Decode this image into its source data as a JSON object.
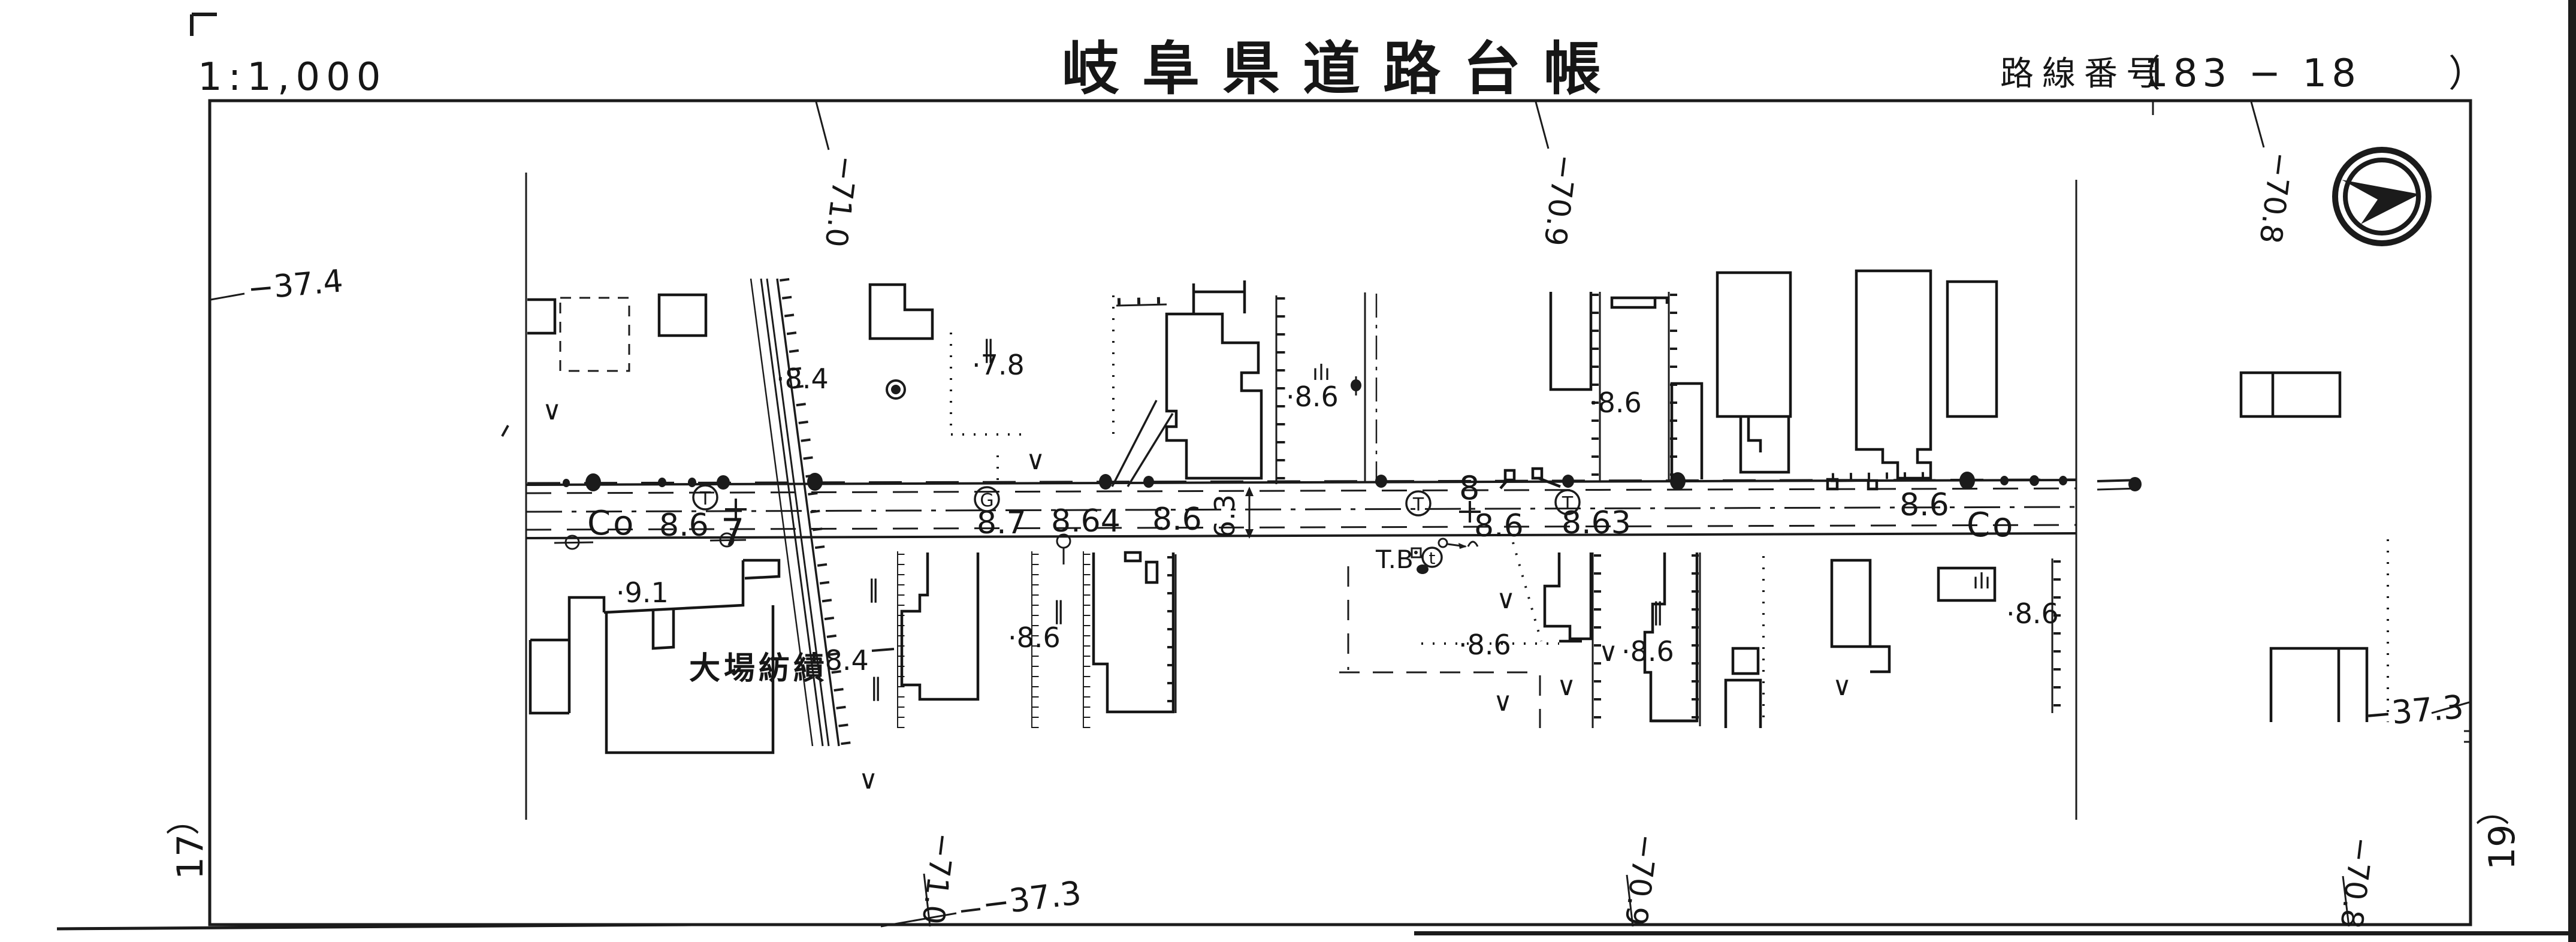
{
  "header": {
    "scale": "1:1,000",
    "title": "岐阜県道路台帳",
    "route_label": "路線番号",
    "route_open": "（",
    "route_number": "183 − 18",
    "route_close": "）"
  },
  "icons": {
    "north_arrow": "double-circle-dart-pointing-right"
  },
  "sheet_refs": {
    "left_paren": "（",
    "left_number": "17",
    "right_paren": "（",
    "right_number": "19"
  },
  "grid_labels": {
    "top": [
      "−71.0",
      "−70.9",
      "−70.8"
    ],
    "bottom": [
      "−71.0",
      "−70.9",
      "−70.8"
    ],
    "left": "−37.4",
    "bottom_diagonal": "−37.3",
    "right": "−37.3"
  },
  "road": {
    "co_left": "Co",
    "co_right": "Co",
    "widths": [
      "8.6",
      "8.7",
      "8.64",
      "8.6",
      "8.6",
      "8.63",
      "8.6"
    ],
    "width_dim": "6.3",
    "stations": [
      "7",
      "8"
    ],
    "telephone_pole_symbol": "T",
    "gas_valve_symbol": "G",
    "benchmark_label": "T.B",
    "benchmark_symbol": "t"
  },
  "map_labels": {
    "factory": "大場紡績",
    "elevations": [
      "·8.4",
      "·7.8",
      "·8.6",
      "·8.6",
      "·9.1",
      "·8.4",
      "·8.6",
      "·8.6",
      "·8.6",
      "·8.6"
    ],
    "symbols": {
      "field": "∨",
      "double_bar": "‖",
      "grass": "ılı"
    }
  }
}
